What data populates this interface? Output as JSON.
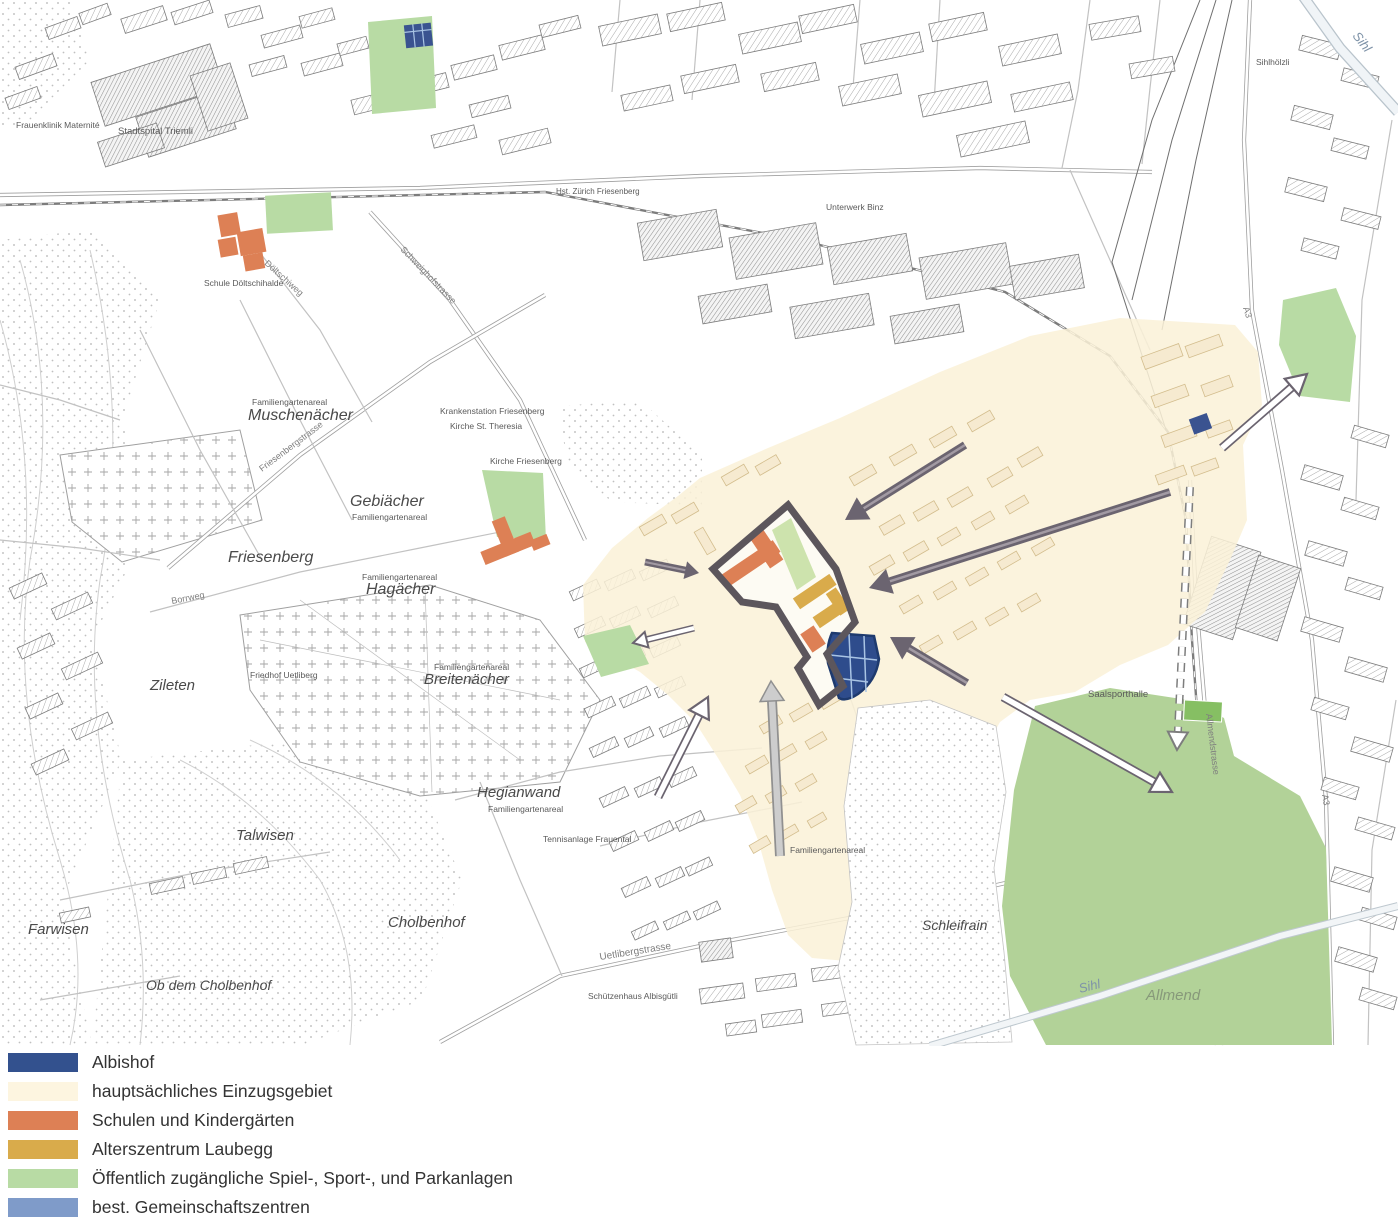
{
  "legend": {
    "items": [
      {
        "label": "Albishof",
        "color": "#33518e"
      },
      {
        "label": "hauptsächliches Einzugsgebiet",
        "color": "#fdf5e0"
      },
      {
        "label": "Schulen und Kindergärten",
        "color": "#dd8055"
      },
      {
        "label": "Alterszentrum Laubegg",
        "color": "#d9ab4b"
      },
      {
        "label": "Öffentlich zugängliche Spiel-, Sport-, und Parkanlagen",
        "color": "#b8dba4"
      },
      {
        "label": "best. Gemeinschaftszentren",
        "color": "#7f9bc9"
      }
    ]
  },
  "palette": {
    "einzugsgebiet": "#faf1d7",
    "schulen": "#dd8055",
    "alterszentrum": "#d9ab4b",
    "parkanlagen": "#b8dba4",
    "gemeinschaftszentren": "#7f9bc9",
    "albishof": "#2e4c8c",
    "albishof_grid": "#a9c4e4",
    "site_boundary": "#5c565c",
    "arrow_dark": "#6b6470"
  },
  "map": {
    "area_labels": [
      {
        "t": "Muschenächer",
        "x": 248,
        "y": 420,
        "s": 16,
        "r": 0,
        "k": "area"
      },
      {
        "t": "Gebiächer",
        "x": 350,
        "y": 506,
        "s": 16,
        "r": 0,
        "k": "area"
      },
      {
        "t": "Friesenberg",
        "x": 228,
        "y": 562,
        "s": 16,
        "r": 0,
        "k": "area"
      },
      {
        "t": "Hagächer",
        "x": 366,
        "y": 594,
        "s": 16,
        "r": 0,
        "k": "area"
      },
      {
        "t": "Zileten",
        "x": 150,
        "y": 690,
        "s": 15,
        "r": 0,
        "k": "area"
      },
      {
        "t": "Breitenächer",
        "x": 424,
        "y": 684,
        "s": 15,
        "r": 0,
        "k": "area"
      },
      {
        "t": "Talwisen",
        "x": 236,
        "y": 840,
        "s": 15,
        "r": 0,
        "k": "area"
      },
      {
        "t": "Farwisen",
        "x": 28,
        "y": 934,
        "s": 15,
        "r": 0,
        "k": "area"
      },
      {
        "t": "Ob dem Cholbenhof",
        "x": 146,
        "y": 990,
        "s": 14,
        "r": 0,
        "k": "area"
      },
      {
        "t": "Cholbenhof",
        "x": 388,
        "y": 927,
        "s": 15,
        "r": 0,
        "k": "area"
      },
      {
        "t": "Hegianwand",
        "x": 477,
        "y": 797,
        "s": 15,
        "r": 0,
        "k": "area"
      },
      {
        "t": "Schleifrain",
        "x": 922,
        "y": 930,
        "s": 14,
        "r": 0,
        "k": "area"
      },
      {
        "t": "Allmend",
        "x": 1146,
        "y": 1000,
        "s": 15,
        "r": 0,
        "k": "allmend"
      },
      {
        "t": "Sihl",
        "x": 1352,
        "y": 36,
        "s": 13,
        "r": 52,
        "k": "water"
      },
      {
        "t": "Sihl",
        "x": 1080,
        "y": 993,
        "s": 13,
        "r": -14,
        "k": "water"
      },
      {
        "t": "Familiengartenareal",
        "x": 252,
        "y": 405,
        "s": 8.5,
        "r": 0,
        "k": "tiny"
      },
      {
        "t": "Familiengartenareal",
        "x": 352,
        "y": 520,
        "s": 8.5,
        "r": 0,
        "k": "tiny"
      },
      {
        "t": "Familiengartenareal",
        "x": 362,
        "y": 580,
        "s": 8.5,
        "r": 0,
        "k": "tiny"
      },
      {
        "t": "Familiengartenareal",
        "x": 434,
        "y": 670,
        "s": 8.5,
        "r": 0,
        "k": "tiny"
      },
      {
        "t": "Familiengartenareal",
        "x": 488,
        "y": 812,
        "s": 8.5,
        "r": 0,
        "k": "tiny"
      },
      {
        "t": "Familiengartenareal",
        "x": 790,
        "y": 853,
        "s": 8.5,
        "r": 0,
        "k": "tiny"
      },
      {
        "t": "Tennisanlage Frauental",
        "x": 543,
        "y": 842,
        "s": 8.5,
        "r": 0,
        "k": "tiny"
      },
      {
        "t": "Stadtspital Triemli",
        "x": 118,
        "y": 134,
        "s": 9.5,
        "r": 0,
        "k": "tiny"
      },
      {
        "t": "Frauenklinik Maternité",
        "x": 16,
        "y": 128,
        "s": 8.5,
        "r": 0,
        "k": "tiny"
      },
      {
        "t": "Schule Döltschihalde",
        "x": 204,
        "y": 286,
        "s": 8.5,
        "r": 0,
        "k": "tiny"
      },
      {
        "t": "Krankenstation Friesenberg",
        "x": 440,
        "y": 414,
        "s": 8.5,
        "r": 0,
        "k": "tiny"
      },
      {
        "t": "Kirche St. Theresia",
        "x": 450,
        "y": 429,
        "s": 8.5,
        "r": 0,
        "k": "tiny"
      },
      {
        "t": "Kirche Friesenberg",
        "x": 490,
        "y": 464,
        "s": 8.5,
        "r": 0,
        "k": "tiny"
      },
      {
        "t": "Friedhof Uetliberg",
        "x": 250,
        "y": 678,
        "s": 8.5,
        "r": 0,
        "k": "tiny"
      },
      {
        "t": "Saalsporthalle",
        "x": 1088,
        "y": 697,
        "s": 9.5,
        "r": 0,
        "k": "tiny"
      },
      {
        "t": "Schützenhaus Albisgütli",
        "x": 588,
        "y": 999,
        "s": 8.5,
        "r": 0,
        "k": "tiny"
      },
      {
        "t": "Unterwerk Binz",
        "x": 826,
        "y": 210,
        "s": 8.5,
        "r": 0,
        "k": "tiny"
      },
      {
        "t": "Hst. Zürich Friesenberg",
        "x": 556,
        "y": 194,
        "s": 8,
        "r": 0,
        "k": "tiny"
      },
      {
        "t": "Sihlhölzli",
        "x": 1256,
        "y": 65,
        "s": 8.5,
        "r": 0,
        "k": "tiny"
      },
      {
        "t": "Uetlibergstrasse",
        "x": 600,
        "y": 960,
        "s": 10,
        "r": -9,
        "k": "street"
      },
      {
        "t": "Allmendstrasse",
        "x": 1206,
        "y": 714,
        "s": 9,
        "r": 83,
        "k": "street"
      },
      {
        "t": "Friesenbergstrasse",
        "x": 262,
        "y": 472,
        "s": 9,
        "r": -37,
        "k": "street"
      },
      {
        "t": "Schweighofstrasse",
        "x": 400,
        "y": 250,
        "s": 9,
        "r": 46,
        "k": "street"
      },
      {
        "t": "Borrweg",
        "x": 172,
        "y": 604,
        "s": 9,
        "r": -11,
        "k": "street"
      },
      {
        "t": "Döltschiweg",
        "x": 264,
        "y": 264,
        "s": 9,
        "r": 42,
        "k": "street"
      },
      {
        "t": "A3",
        "x": 1243,
        "y": 308,
        "s": 9,
        "r": 72,
        "k": "street"
      },
      {
        "t": "A3",
        "x": 1322,
        "y": 795,
        "s": 9,
        "r": 80,
        "k": "street"
      }
    ],
    "arrows": [
      {
        "from": [
          965,
          445
        ],
        "to": [
          845,
          520
        ],
        "style": "solid-dark"
      },
      {
        "from": [
          1170,
          492
        ],
        "to": [
          869,
          588
        ],
        "style": "solid-dark"
      },
      {
        "from": [
          967,
          683
        ],
        "to": [
          890,
          637
        ],
        "style": "solid-dark"
      },
      {
        "from": [
          645,
          562
        ],
        "to": [
          699,
          573
        ],
        "style": "solid-dark-small"
      },
      {
        "from": [
          780,
          856
        ],
        "to": [
          771,
          681
        ],
        "style": "solid-light"
      },
      {
        "from": [
          1222,
          448
        ],
        "to": [
          1307,
          374
        ],
        "style": "outline"
      },
      {
        "from": [
          1003,
          697
        ],
        "to": [
          1172,
          792
        ],
        "style": "outline"
      },
      {
        "from": [
          694,
          628
        ],
        "to": [
          633,
          643
        ],
        "style": "outline-small"
      },
      {
        "from": [
          658,
          797
        ],
        "to": [
          708,
          697
        ],
        "style": "outline"
      },
      {
        "from": [
          1190,
          487
        ],
        "to": [
          1177,
          750
        ],
        "style": "dashed"
      }
    ]
  }
}
